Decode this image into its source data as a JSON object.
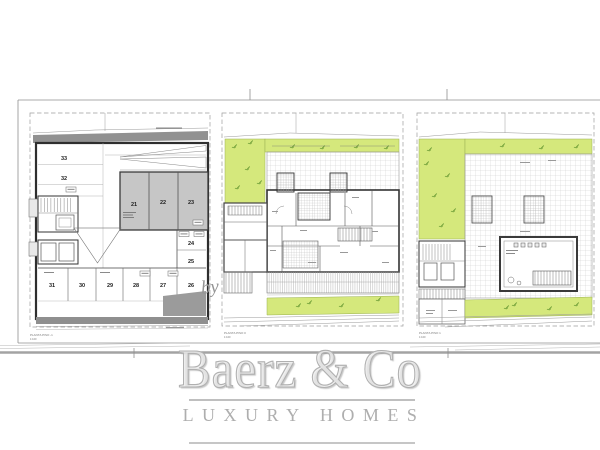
{
  "watermark": {
    "by": "by",
    "brand": "Baerz & Co",
    "tagline": "LUXURY HOMES"
  },
  "plans": [
    {
      "title": "PLANTA PISO -1",
      "scale": "1:100",
      "spaces": {
        "left_top": "33",
        "left_bottom": "32",
        "block": [
          "21",
          "22",
          "23"
        ],
        "right": [
          "24",
          "25"
        ],
        "bottom": [
          "31",
          "30",
          "29",
          "28",
          "27",
          "26"
        ]
      }
    },
    {
      "title": "PLANTA PISO 0",
      "scale": "1:100"
    },
    {
      "title": "PLANTA PISO 1",
      "scale": "1:100"
    }
  ],
  "colors": {
    "garden_green": "#d5e87c",
    "plant_green": "#6f9f38",
    "wall_gray": "#8f8f8f",
    "parking_block_gray": "#c6c6c6",
    "line_dark": "#333333",
    "watermark_gray": "#b0b0b0"
  }
}
